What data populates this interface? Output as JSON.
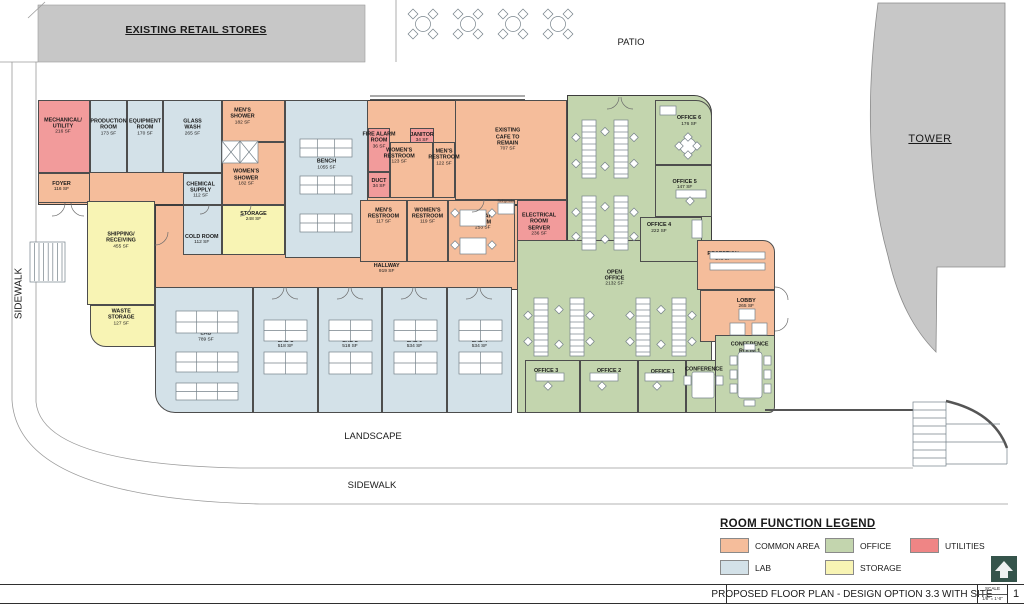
{
  "site": {
    "retail_label": "EXISTING RETAIL STORES",
    "patio_label": "PATIO",
    "tower_label": "TOWER",
    "sidewalk_left_label": "SIDEWALK",
    "landscape_label": "LANDSCAPE",
    "sidewalk_bottom_label": "SIDEWALK",
    "refrigerator_label": "Refrigerator",
    "site_gray": "#C7C7C7"
  },
  "legend": {
    "title": "ROOM FUNCTION LEGEND",
    "items": [
      {
        "category": "common",
        "label": "COMMON AREA",
        "color": "#F5BD9B"
      },
      {
        "category": "office",
        "label": "OFFICE",
        "color": "#C3D5AE"
      },
      {
        "category": "utilities",
        "label": "UTILITIES",
        "color": "#EF8585",
        "room_fill": "#F29B9B"
      },
      {
        "category": "lab",
        "label": "LAB",
        "color": "#D3E1E8"
      },
      {
        "category": "storage",
        "label": "STORAGE",
        "color": "#F8F4B4"
      }
    ]
  },
  "titleblock": {
    "title": "PROPOSED FLOOR PLAN - DESIGN OPTION 3.3 WITH SITE",
    "scale_label": "SCALE",
    "scale_value": "1/8\" = 1'-0\"",
    "sheet_number": "1",
    "logo_color": "#35544B"
  },
  "rooms": [
    {
      "id": "mechanical-utility",
      "cat": "utilities",
      "name": "MECHANICAL/\nUTILITY",
      "sf": "216 SF",
      "x": 38,
      "y": 100,
      "w": 52,
      "h": 73,
      "lx": 48,
      "ly": 36
    },
    {
      "id": "production-room",
      "cat": "lab",
      "name": "PRODUCTION\nROOM",
      "sf": "173 SF",
      "x": 90,
      "y": 100,
      "w": 37,
      "h": 73,
      "lx": 50,
      "ly": 38
    },
    {
      "id": "equipment-room",
      "cat": "lab",
      "name": "EQUIPMENT\nROOM",
      "sf": "170 SF",
      "x": 127,
      "y": 100,
      "w": 36,
      "h": 73,
      "lx": 50,
      "ly": 38
    },
    {
      "id": "glass-wash",
      "cat": "lab",
      "name": "GLASS\nWASH",
      "sf": "265 SF",
      "x": 163,
      "y": 100,
      "w": 59,
      "h": 73,
      "lx": 50,
      "ly": 38
    },
    {
      "id": "mens-shower",
      "cat": "common",
      "name": "MEN'S\nSHOWER",
      "sf": "182 SF",
      "x": 222,
      "y": 100,
      "w": 63,
      "h": 42,
      "lx": 32,
      "ly": 40
    },
    {
      "id": "womens-shower",
      "cat": "common",
      "name": "WOMEN'S\nSHOWER",
      "sf": "182 SF",
      "x": 222,
      "y": 142,
      "w": 63,
      "h": 63,
      "lx": 38,
      "ly": 58
    },
    {
      "id": "foyer",
      "cat": "common",
      "name": "FOYER",
      "sf": "116 SF",
      "x": 38,
      "y": 173,
      "w": 52,
      "h": 30,
      "lx": 45,
      "ly": 45
    },
    {
      "id": "chemical-supply",
      "cat": "lab",
      "name": "CHEMICAL\nSUPPLY",
      "sf": "112 SF",
      "x": 183,
      "y": 173,
      "w": 39,
      "h": 32,
      "lx": 45,
      "ly": 55
    },
    {
      "id": "cold-room",
      "cat": "lab",
      "name": "COLD ROOM",
      "sf": "112 SF",
      "x": 183,
      "y": 205,
      "w": 39,
      "h": 50,
      "lx": 48,
      "ly": 70
    },
    {
      "id": "storage",
      "cat": "storage",
      "name": "STORAGE",
      "sf": "248 SF",
      "x": 222,
      "y": 205,
      "w": 63,
      "h": 50,
      "lx": 50,
      "ly": 22
    },
    {
      "id": "shipping-receiving",
      "cat": "storage",
      "name": "SHIPPING/\nRECEIVING",
      "sf": "455 SF",
      "x": 87,
      "y": 201,
      "w": 68,
      "h": 104,
      "lx": 50,
      "ly": 38
    },
    {
      "id": "waste-storage",
      "cat": "storage",
      "name": "WASTE\nSTORAGE",
      "sf": "127 SF",
      "x": 90,
      "y": 305,
      "w": 65,
      "h": 42,
      "lx": 48,
      "ly": 30,
      "r": "0 0 0 16px"
    },
    {
      "id": "open-lab-bench",
      "cat": "lab",
      "name": "OPEN LAB\nBENCH",
      "sf": "1055 SF",
      "x": 285,
      "y": 100,
      "w": 83,
      "h": 158,
      "lx": 50,
      "ly": 39
    },
    {
      "id": "fire-alarm-room",
      "cat": "utilities",
      "name": "FIRE ALARM\nROOM",
      "sf": "36 SF",
      "x": 368,
      "y": 128,
      "w": 22,
      "h": 44,
      "lx": 50,
      "ly": 28
    },
    {
      "id": "duct",
      "cat": "utilities",
      "name": "DUCT",
      "sf": "34 SF",
      "x": 368,
      "y": 172,
      "w": 22,
      "h": 26,
      "lx": 50,
      "ly": 45
    },
    {
      "id": "janitor",
      "cat": "utilities",
      "name": "JANITOR",
      "sf": "34 SF",
      "x": 410,
      "y": 128,
      "w": 24,
      "h": 22,
      "lx": 50,
      "ly": 45
    },
    {
      "id": "womens-restroom-2",
      "cat": "common",
      "name": "WOMEN'S\nRESTROOM",
      "sf": "123 SF",
      "x": 390,
      "y": 142,
      "w": 43,
      "h": 56,
      "lx": 20,
      "ly": 25
    },
    {
      "id": "mens-restroom-2",
      "cat": "common",
      "name": "MEN'S\nRESTROOM",
      "sf": "122 SF",
      "x": 433,
      "y": 142,
      "w": 22,
      "h": 56,
      "lx": 50,
      "ly": 28
    },
    {
      "id": "existing-cafe",
      "cat": "common",
      "name": "EXISTING\nCAFE TO\nREMAIN",
      "sf": "707 SF",
      "x": 455,
      "y": 100,
      "w": 112,
      "h": 100,
      "lx": 47,
      "ly": 40
    },
    {
      "id": "mens-restroom-1",
      "cat": "common",
      "name": "MEN'S\nRESTROOM",
      "sf": "117 SF",
      "x": 360,
      "y": 200,
      "w": 47,
      "h": 62,
      "lx": 50,
      "ly": 26
    },
    {
      "id": "womens-restroom-1",
      "cat": "common",
      "name": "WOMEN'S\nRESTROOM",
      "sf": "119 SF",
      "x": 407,
      "y": 200,
      "w": 41,
      "h": 62,
      "lx": 50,
      "ly": 26
    },
    {
      "id": "break-room",
      "cat": "common",
      "name": "BREAK\nROOM",
      "sf": "253 SF",
      "x": 448,
      "y": 200,
      "w": 67,
      "h": 62,
      "lx": 52,
      "ly": 36
    },
    {
      "id": "electrical-room-server",
      "cat": "utilities",
      "name": "ELECTRICAL\nROOM/\nSERVER",
      "sf": "236 SF",
      "x": 517,
      "y": 200,
      "w": 50,
      "h": 62,
      "lx": 44,
      "ly": 40
    },
    {
      "id": "hallway",
      "cat": "common",
      "name": "HALLWAY",
      "sf": "919 SF",
      "x": 155,
      "y": 255,
      "w": 362,
      "h": 35,
      "lx": 64,
      "ly": 40,
      "nofill": true,
      "noborder": true
    },
    {
      "id": "chemical-lab",
      "cat": "lab",
      "name": "CHEMICAL\nLAB",
      "sf": "789 SF",
      "x": 155,
      "y": 287,
      "w": 98,
      "h": 126,
      "lx": 52,
      "ly": 37,
      "r": "0 0 0 20px"
    },
    {
      "id": "lab-1",
      "cat": "lab",
      "name": "LAB 1",
      "sf": "518 SF",
      "x": 253,
      "y": 287,
      "w": 65,
      "h": 126,
      "lx": 50,
      "ly": 45
    },
    {
      "id": "lab-2",
      "cat": "lab",
      "name": "LAB 2",
      "sf": "518 SF",
      "x": 318,
      "y": 287,
      "w": 64,
      "h": 126,
      "lx": 50,
      "ly": 45
    },
    {
      "id": "lab-3",
      "cat": "lab",
      "name": "LAB 3",
      "sf": "534 SF",
      "x": 382,
      "y": 287,
      "w": 65,
      "h": 126,
      "lx": 50,
      "ly": 45
    },
    {
      "id": "lab-4",
      "cat": "lab",
      "name": "LAB 4",
      "sf": "534 SF",
      "x": 447,
      "y": 287,
      "w": 65,
      "h": 126,
      "lx": 50,
      "ly": 45
    },
    {
      "id": "open-office",
      "cat": "office",
      "name": "OPEN\nOFFICE",
      "sf": "2132 SF",
      "x": 517,
      "y": 240,
      "w": 195,
      "h": 173,
      "lx": 50,
      "ly": 22
    },
    {
      "id": "office-6",
      "cat": "office",
      "name": "OFFICE 6",
      "sf": "176 SF",
      "x": 655,
      "y": 100,
      "w": 57,
      "h": 65,
      "lx": 60,
      "ly": 32,
      "r": "0 16px 0 0"
    },
    {
      "id": "office-5",
      "cat": "office",
      "name": "OFFICE 5",
      "sf": "147 SF",
      "x": 655,
      "y": 165,
      "w": 57,
      "h": 52,
      "lx": 52,
      "ly": 38
    },
    {
      "id": "office-4",
      "cat": "office",
      "name": "OFFICE 4",
      "sf": "222 SF",
      "x": 640,
      "y": 217,
      "w": 62,
      "h": 45,
      "lx": 30,
      "ly": 24
    },
    {
      "id": "office-3",
      "cat": "office",
      "name": "OFFICE 3",
      "sf": "199 SF",
      "x": 525,
      "y": 360,
      "w": 55,
      "h": 53,
      "lx": 38,
      "ly": 26
    },
    {
      "id": "office-2",
      "cat": "office",
      "name": "OFFICE 2",
      "sf": "197 SF",
      "x": 580,
      "y": 360,
      "w": 58,
      "h": 53,
      "lx": 50,
      "ly": 26
    },
    {
      "id": "office-1",
      "cat": "office",
      "name": "OFFICE 1",
      "sf": "141 SF",
      "x": 638,
      "y": 360,
      "w": 48,
      "h": 53,
      "lx": 52,
      "ly": 28
    },
    {
      "id": "conference-room-2",
      "cat": "office",
      "name": "CONFERENCE\nROOM 2",
      "sf": "122 SF",
      "x": 686,
      "y": 360,
      "w": 36,
      "h": 53,
      "lx": 50,
      "ly": 30
    },
    {
      "id": "reception",
      "cat": "common",
      "name": "RECEPTION",
      "sf": "248 SF",
      "x": 697,
      "y": 240,
      "w": 78,
      "h": 50,
      "lx": 33,
      "ly": 33,
      "r": "0 12px 0 0"
    },
    {
      "id": "lobby",
      "cat": "common",
      "name": "LOBBY",
      "sf": "265 SF",
      "x": 700,
      "y": 290,
      "w": 75,
      "h": 52,
      "lx": 62,
      "ly": 25
    },
    {
      "id": "conference-room-1",
      "cat": "office",
      "name": "CONFERENCE\nROOM 1",
      "sf": "213 SF",
      "x": 715,
      "y": 335,
      "w": 60,
      "h": 78,
      "lx": 58,
      "ly": 20,
      "r": "0 0 6px 0"
    }
  ]
}
